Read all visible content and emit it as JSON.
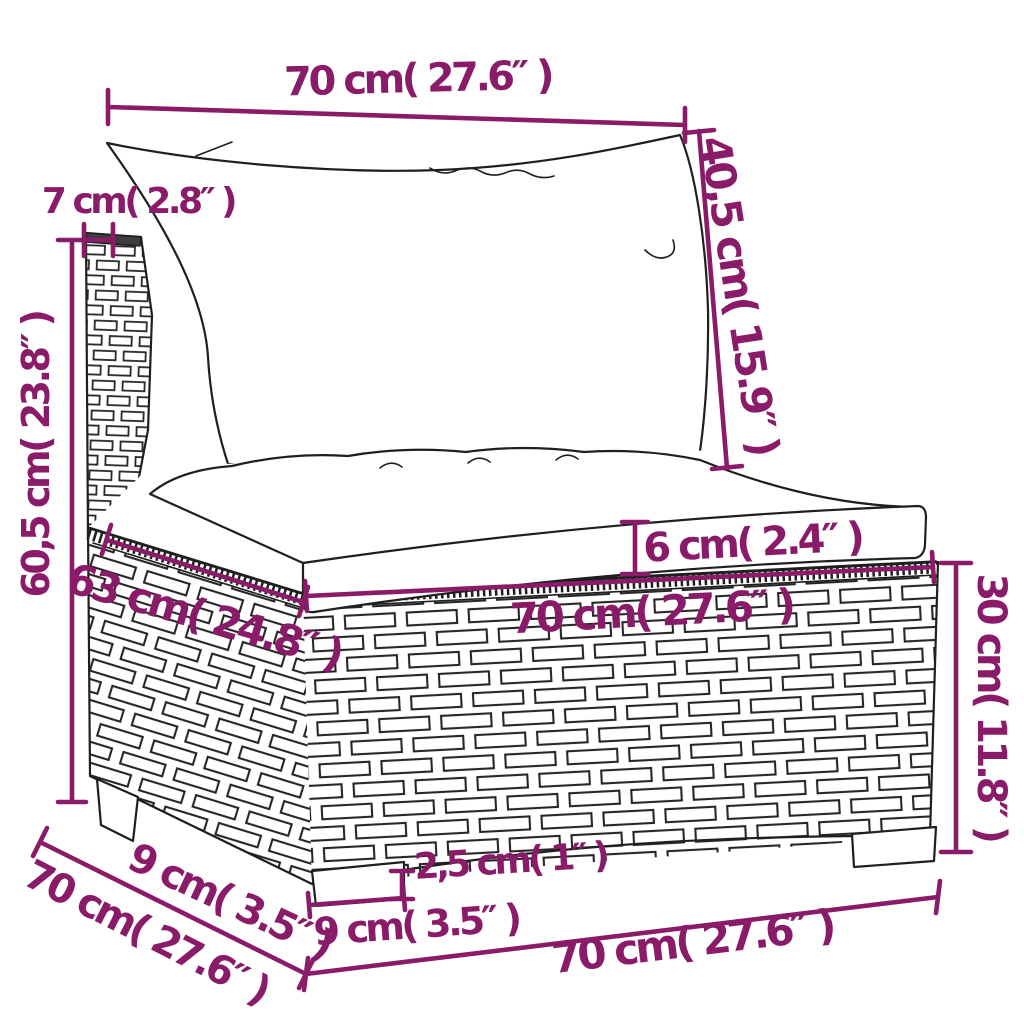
{
  "diagram": {
    "title": "outdoor-rattan-sofa-middle-section-dimension-drawing",
    "style": {
      "accent_color": "#8a1b69",
      "line_color": "#1f1f1f",
      "background_color": "#ffffff"
    },
    "dims": {
      "back_width": {
        "label": "70 cm( 27.6″ )"
      },
      "back_cushion_height": {
        "label": "40,5 cm( 15.9″ )"
      },
      "frame_thickness": {
        "label": "7 cm( 2.8″ )"
      },
      "total_height": {
        "label": "60,5 cm( 23.8″ )"
      },
      "cushion_thickness": {
        "label": "6 cm( 2.4″ )"
      },
      "seat_width": {
        "label": "70 cm( 27.6″ )"
      },
      "seat_depth": {
        "label": "63 cm( 24.8″ )"
      },
      "base_height": {
        "label": "30 cm( 11.8″ )"
      },
      "foot_height": {
        "label": "2,5 cm( 1″ )"
      },
      "foot_width": {
        "label": "9 cm( 3.5″ )"
      },
      "side_foot_width": {
        "label": "9 cm( 3.5″ )"
      },
      "side_depth": {
        "label": "70 cm( 27.6″ )"
      },
      "base_width": {
        "label": "70 cm( 27.6″ )"
      }
    }
  }
}
